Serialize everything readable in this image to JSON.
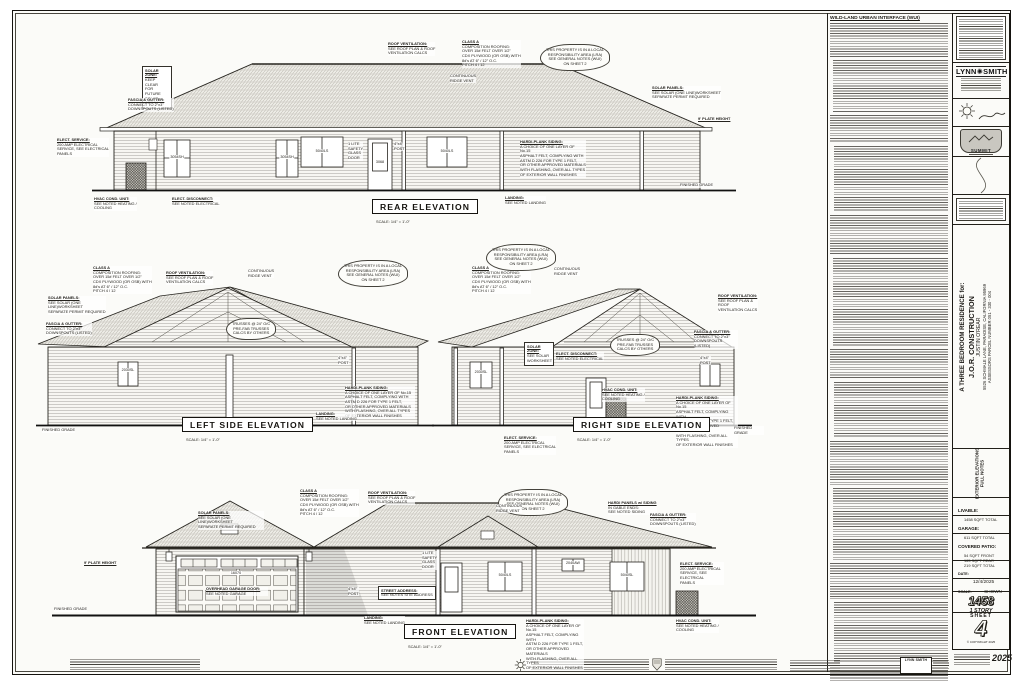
{
  "labels": {
    "rear": {
      "title": "REAR ELEVATION",
      "scale": "SCALE: 1/4\" = 1'-0\""
    },
    "left": {
      "title": "LEFT SIDE ELEVATION",
      "scale": "SCALE: 1/4\" = 1'-0\""
    },
    "right": {
      "title": "RIGHT SIDE ELEVATION",
      "scale": "SCALE: 1/4\" = 1'-0\""
    },
    "front": {
      "title": "FRONT ELEVATION",
      "scale": "SCALE: 1/4\" = 1'-0\""
    }
  },
  "notes_column": {
    "heading": "WILD-LAND URBAN INTERFACE (WUI)"
  },
  "title_block": {
    "firm_left": "LYNN",
    "firm_right": "SMITH",
    "summit": "SUMMIT",
    "project_line1": "A THREE BEDROOM RESIDENCE for:",
    "project_line2": "J.O.R. CONSTRUCTION",
    "project_line3": "JUSTIN O'REAR",
    "project_line4": "5526 SCHMALE LANE, PARADISE, CALIFORNIA 95969",
    "project_line5": "ASSESSORS PARCEL NUMBER 051 - 330 - 004",
    "discipline_line1": "EXTERIOR ELEVATIONS",
    "discipline_line2": "FULL NOTES",
    "livable_label": "LIVABLE:",
    "livable_value": "1458 SQFT TOTAL",
    "garage_label": "GARAGE:",
    "garage_value": "611 SQFT TOTAL",
    "patio_label": "COVERED PATIO:",
    "patio_value": "54 SQFT FRONT\n165 SQFT REAR\n219 SQFT TOTAL",
    "date_label": "DATE:",
    "date_value": "12/4/2025",
    "scale_label": "SCALE:",
    "scale_value": "SHOWN",
    "sqft_big": "1458",
    "story": "1 STORY",
    "sheet_label": "SHEET",
    "sheet_number": "4",
    "copyright": "© COPYRIGHT 2025",
    "year_stamp": "2025"
  },
  "bottom_strip": {
    "firm_mini": "LYNN SMITH"
  },
  "colors": {
    "ink": "#1c1a16",
    "paper": "#fbfbf8",
    "roof_hatch": "#a39f96",
    "siding_line": "#97948d"
  },
  "callout_texts": {
    "CLASSA": "CLASS A\nCOMPOSITION ROOFING:\nOVER 15# FELT OVER 1/2\"\nCDX PLYWOOD (OR OSB) WITH\n8d's AT 6\" / 12\" O.C.\nPITCH 4 / 12",
    "ROOFVENT": "ROOF VENTILATION:\nSEE ROOF PLAN & ROOF\nVENTILATION CALCS",
    "LRA": "THIS PROPERTY IS IN A LOCAL\nRESPONSIBILITY AREA (LRA)\nSEE GENERAL NOTES (WUI)\nON SHEET 2",
    "SOLARP": "SOLAR PANELS:\nSEE SOLAR (ONE LINE)WORKSHEET\nSEPARATE PERMIT REQUIRED",
    "FASCIA": "FASCIA & GUTTER:\nCONNECT TO 2\"x3\"\nDOWNSPOUTS (LISTED)",
    "HARDI": "HARDI-PLANK SIDING:\nA CHOICE OF ONE LAYER OF No.15\nASPHALT FELT, COMPLYING WITH\nASTM D 226 FOR TYPE 1 FELT,\nOR OTHER APPROVED MATERIALS\nWITH FLASHING, OVER ALL TYPES\nOF EXTERIOR WALL FINISHES",
    "HVACU": "HVAC COND. UNIT:\nSEE NOTED HEATING /\nCOOLING",
    "ELECTD": "ELECT. DISCONNECT:\nSEE NOTED ELECTRICAL",
    "ELECTS": "ELECT. SERVICE:\n200 AMP ELECTRICAL\nSERVICE, SEE ELECTRICAL\nPANELS",
    "LANDING": "LANDING:\nSEE NOTED LANDING",
    "RIDGE": "CONTINUOUS\nRIDGE VENT",
    "TRUSS": "TRUSSES @ 24\" O/C\nPRE-FAB TRUSSES\nCALCS BY OTHERS",
    "POST": "4\"x4\"\nPOST",
    "PLATE": "9' PLATE HEIGHT",
    "GRADE": "FINISHED GRADE",
    "DOOR1L": "1 LITE\nSAFETY\nGLASS\nDOOR",
    "STREET": "STREET ADDRESS:\nSEE NOTES SITE ADDRESS",
    "OHD": "OVERHEAD GARAGE DOOR:\nSEE NOTED GARAGE",
    "HPANEL": "HARDI PANELS w/ SIDING\nIN GABLE ENDS:\nSEE NOTED SIDING",
    "SOLARZ": "SOLAR ZONE:\nKEEP CLEAR\nFOR FUTURE\nSOLAR ARRAY",
    "SOLARZ2": "SOLAR ZONE:\nSEE SOLAR\nWORKSHEET"
  },
  "annotations": [
    {
      "x": 142,
      "y": 66,
      "w": 24,
      "t": "SOLARZ",
      "c": "boxed",
      "tl": 1
    },
    {
      "x": 128,
      "y": 98,
      "t": "FASCIA",
      "tl": 1
    },
    {
      "x": 57,
      "y": 138,
      "t": "ELECTS",
      "tl": 1
    },
    {
      "x": 94,
      "y": 197,
      "t": "HVACU",
      "tl": 1
    },
    {
      "x": 172,
      "y": 197,
      "t": "ELECTD",
      "tl": 1
    },
    {
      "x": 388,
      "y": 42,
      "t": "ROOFVENT",
      "tl": 1
    },
    {
      "x": 462,
      "y": 40,
      "t": "CLASSA",
      "tl": 1
    },
    {
      "x": 450,
      "y": 74,
      "t": "RIDGE"
    },
    {
      "x": 540,
      "y": 44,
      "t": "LRA",
      "c": "cloud"
    },
    {
      "x": 652,
      "y": 86,
      "t": "SOLARP",
      "tl": 1
    },
    {
      "x": 698,
      "y": 117,
      "t": "PLATE",
      "tl": 1
    },
    {
      "x": 680,
      "y": 183,
      "t": "GRADE"
    },
    {
      "x": 348,
      "y": 142,
      "t": "DOOR1L"
    },
    {
      "x": 394,
      "y": 142,
      "t": "POST"
    },
    {
      "x": 520,
      "y": 140,
      "w": 66,
      "t": "HARDI",
      "tl": 1
    },
    {
      "x": 505,
      "y": 196,
      "t": "LANDING",
      "tl": 1
    },
    {
      "x": 177,
      "y": 155,
      "t": "3054SH",
      "c": "ctr",
      "n": "window-size-label"
    },
    {
      "x": 287,
      "y": 155,
      "t": "3054SH",
      "c": "ctr",
      "n": "window-size-label"
    },
    {
      "x": 322,
      "y": 149,
      "t": "5040LS",
      "c": "ctr",
      "n": "window-size-label"
    },
    {
      "x": 380,
      "y": 160,
      "t": "3068",
      "c": "ctr",
      "n": "door-size-label"
    },
    {
      "x": 447,
      "y": 149,
      "t": "5040LS",
      "c": "ctr",
      "n": "window-size-label"
    },
    {
      "x": 93,
      "y": 266,
      "t": "CLASSA",
      "tl": 1
    },
    {
      "x": 166,
      "y": 271,
      "t": "ROOFVENT",
      "tl": 1
    },
    {
      "x": 338,
      "y": 260,
      "t": "LRA",
      "c": "cloud"
    },
    {
      "x": 248,
      "y": 269,
      "t": "RIDGE"
    },
    {
      "x": 48,
      "y": 296,
      "w": 58,
      "t": "SOLARP",
      "tl": 1
    },
    {
      "x": 46,
      "y": 322,
      "t": "FASCIA",
      "tl": 1
    },
    {
      "x": 226,
      "y": 318,
      "t": "TRUSS",
      "c": "cloud"
    },
    {
      "x": 338,
      "y": 356,
      "t": "POST"
    },
    {
      "x": 345,
      "y": 386,
      "w": 70,
      "t": "HARDI",
      "tl": 1
    },
    {
      "x": 316,
      "y": 412,
      "t": "LANDING",
      "tl": 1
    },
    {
      "x": 42,
      "y": 428,
      "t": "GRADE"
    },
    {
      "x": 128,
      "y": 368,
      "t": "2030SL",
      "c": "ctr",
      "n": "window-size-label"
    },
    {
      "x": 472,
      "y": 266,
      "t": "CLASSA",
      "tl": 1
    },
    {
      "x": 486,
      "y": 244,
      "t": "LRA",
      "c": "cloud"
    },
    {
      "x": 554,
      "y": 267,
      "t": "RIDGE"
    },
    {
      "x": 718,
      "y": 294,
      "w": 40,
      "t": "ROOFVENT",
      "tl": 1
    },
    {
      "x": 694,
      "y": 330,
      "w": 44,
      "t": "FASCIA",
      "tl": 1
    },
    {
      "x": 610,
      "y": 334,
      "t": "TRUSS",
      "c": "cloud"
    },
    {
      "x": 524,
      "y": 342,
      "w": 24,
      "t": "SOLARZ2",
      "c": "boxed",
      "tl": 1
    },
    {
      "x": 556,
      "y": 352,
      "t": "ELECTD",
      "tl": 1
    },
    {
      "x": 602,
      "y": 388,
      "t": "HVACU",
      "tl": 1
    },
    {
      "x": 700,
      "y": 356,
      "t": "POST"
    },
    {
      "x": 676,
      "y": 396,
      "w": 62,
      "t": "HARDI",
      "tl": 1
    },
    {
      "x": 504,
      "y": 436,
      "t": "ELECTS",
      "tl": 1
    },
    {
      "x": 734,
      "y": 426,
      "w": 30,
      "t": "GRADE"
    },
    {
      "x": 481,
      "y": 370,
      "t": "2030SL",
      "c": "ctr",
      "n": "window-size-label"
    },
    {
      "x": 300,
      "y": 489,
      "t": "CLASSA",
      "tl": 1
    },
    {
      "x": 368,
      "y": 491,
      "t": "ROOFVENT",
      "tl": 1
    },
    {
      "x": 498,
      "y": 489,
      "t": "LRA",
      "c": "cloud"
    },
    {
      "x": 608,
      "y": 501,
      "t": "HPANEL",
      "tl": 1
    },
    {
      "x": 198,
      "y": 511,
      "w": 66,
      "t": "SOLARP",
      "tl": 1
    },
    {
      "x": 650,
      "y": 513,
      "t": "FASCIA",
      "tl": 1
    },
    {
      "x": 84,
      "y": 561,
      "t": "PLATE",
      "tl": 1
    },
    {
      "x": 54,
      "y": 607,
      "t": "GRADE"
    },
    {
      "x": 496,
      "y": 504,
      "t": "RIDGE"
    },
    {
      "x": 206,
      "y": 587,
      "w": 62,
      "t": "OHD",
      "tl": 1
    },
    {
      "x": 236,
      "y": 571,
      "t": "16070",
      "c": "ctr",
      "n": "door-size-label"
    },
    {
      "x": 378,
      "y": 586,
      "t": "STREET",
      "c": "boxed",
      "tl": 1
    },
    {
      "x": 348,
      "y": 587,
      "t": "POST"
    },
    {
      "x": 422,
      "y": 551,
      "t": "DOOR1L"
    },
    {
      "x": 505,
      "y": 573,
      "t": "5040LS",
      "c": "ctr",
      "n": "window-size-label"
    },
    {
      "x": 573,
      "y": 561,
      "t": "2040AW",
      "c": "ctr",
      "n": "window-size-label"
    },
    {
      "x": 627,
      "y": 573,
      "t": "5040SL",
      "c": "ctr",
      "n": "window-size-label"
    },
    {
      "x": 680,
      "y": 562,
      "w": 44,
      "t": "ELECTS",
      "tl": 1
    },
    {
      "x": 676,
      "y": 619,
      "t": "HVACU",
      "tl": 1
    },
    {
      "x": 526,
      "y": 619,
      "w": 58,
      "t": "HARDI",
      "tl": 1
    },
    {
      "x": 364,
      "y": 616,
      "t": "LANDING",
      "tl": 1
    }
  ]
}
